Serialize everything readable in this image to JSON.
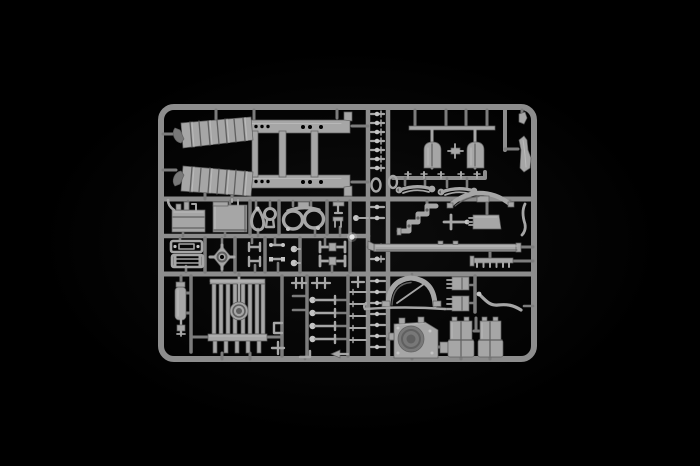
{
  "scene": {
    "description": "Product photograph of a grey injection-moulded model kit sprue (parts tree) lit against a plain black background",
    "subject": "plastic sprue with unassembled scale-model truck parts",
    "background": "black studio backdrop"
  },
  "colors": {
    "bg": "#000000",
    "vignette": "#0d0d0d",
    "runner": "#8d8d8d",
    "runner_soft": "#7c7c7c",
    "plastic": "#a6a6a6",
    "plastic_hi": "#c4c4c4",
    "plastic_lo": "#606060",
    "plastic_deep": "#787878",
    "glint": "#efefef"
  },
  "sprue": {
    "material": "grey styrene plastic",
    "frame": "Rectangular sprue frame with internal runners",
    "parts": {
      "ladder_chassis": "Truck ladder chassis frame with rivet holes",
      "fender_upper": "Ribbed track fender, upper",
      "fender_lower": "Ribbed track fender, lower",
      "pin_column": "Column of small bolt pins",
      "tank_rack": "Hanger rack with two round-topped tank halves",
      "spring_rail": "Rail with small cross fittings",
      "leaf_springs": "Pair of leaf springs",
      "exhaust_stack": "Curved exhaust stack",
      "engine_block": "Engine block with piping",
      "storage_box": "Rectangular stowage box",
      "teardrop_ring": "Teardrop-shaped ring",
      "bulb_ring": "Bulb-shaped ring",
      "twin_oval_frame": "Twin oval frame with top tab",
      "ladder_frames_small": "Two small ladder frames",
      "hub_cross": "Cross-shaped hub with centre ring",
      "clip_set": "Small clips and dumbbell rods",
      "axle_yokes": "Two axle yokes",
      "elbow_pipe": "Stepped exhaust elbow pipe",
      "arched_bracket": "Arched bracket with centre lug",
      "tee_rod": "Tee-shaped rod",
      "side_plate": "Bevelled side plate with pins",
      "running_board": "Long running board",
      "toothed_rack": "Toothed rack bar",
      "cylinder_tank": "Vertical cylinder tank with valve",
      "radiator": "Slatted radiator with round filler hub",
      "linkage_levers": "Columns of linkage levers and ball pins",
      "wheel_arch": "Wheel-arch fender with brace",
      "tie_rod": "Thin curved tie rod",
      "connector_blocks": "Two pinned connector blocks",
      "hose": "Curved flexible hose",
      "gearbox": "Gearbox housing with round bore",
      "seat_left": "Box seat, left",
      "seat_right": "Box seat, right"
    }
  }
}
